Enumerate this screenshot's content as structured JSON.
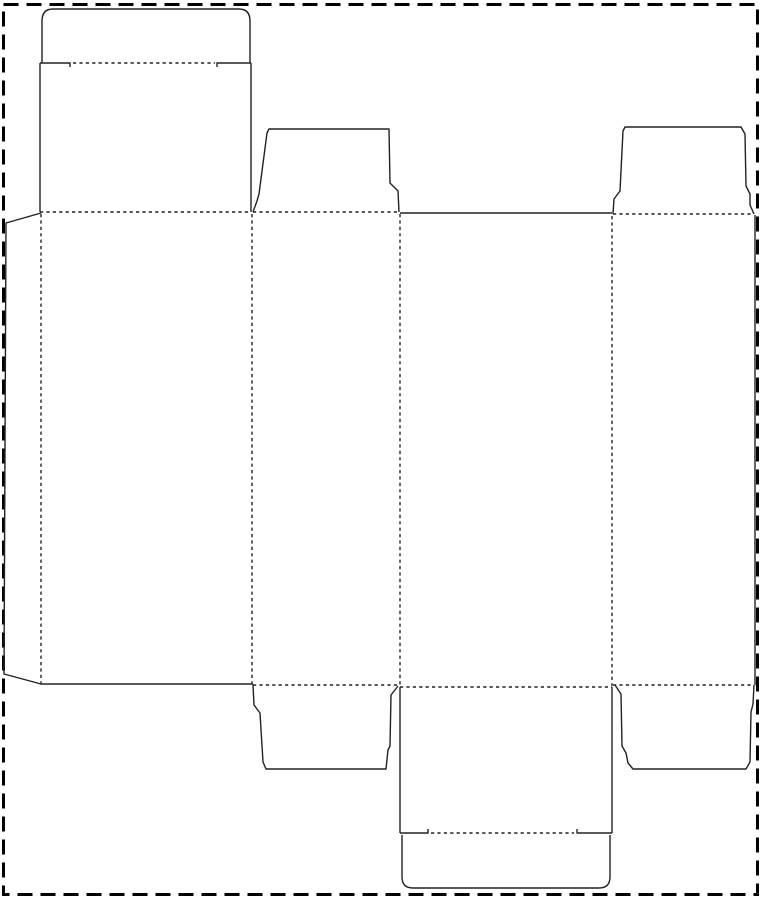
{
  "canvas": {
    "width": 761,
    "height": 900,
    "background_color": "#ffffff"
  },
  "styles": {
    "cut_line_color": "#222222",
    "cut_line_width": 1.4,
    "fold_line_color": "#222222",
    "fold_line_width": 1.4,
    "fold_dash_pattern": "3.2,3.2",
    "border_color": "#000000",
    "border_width": 3,
    "border_dash_pattern": "15,8"
  },
  "border_rect": {
    "x": 3.5,
    "y": 4.5,
    "width": 754,
    "height": 890
  },
  "cut_paths": [
    {
      "name": "top-tuck-flap-outline",
      "d": "M42,63 L42,21 Q42,9 53,9 L239,9 Q250,9 250,21 L250,63"
    },
    {
      "name": "top-tuck-fold-left-shoulder",
      "d": "M40,63 L70,63 L70,67"
    },
    {
      "name": "top-tuck-fold-right-shoulder",
      "d": "M217,67 L217,63 L251,63"
    },
    {
      "name": "back-lid-left-edge",
      "d": "M40,63 L40,212"
    },
    {
      "name": "back-lid-right-edge",
      "d": "M251,63 L251,212"
    },
    {
      "name": "glue-flap-outline",
      "d": "M41,213 L6,223 L4,674 L41,684"
    },
    {
      "name": "back-panel-bottom-edge",
      "d": "M40,684 L253,684"
    },
    {
      "name": "top-middle-dust-flap-outline",
      "d": "M253,212 L257,201 L259,194 L267,133 L269,129 L389,129 L390,183 L398,191 L399,212"
    },
    {
      "name": "front-panel-top-edge",
      "d": "M400,213 L612,213"
    },
    {
      "name": "top-right-dust-flap-outline",
      "d": "M613,214 L614,199 L620,191 L623,131 L625,127 L741,127 L745,134 L746,186 L750,194 L750,205 L754,214"
    },
    {
      "name": "right-panel-right-edge",
      "d": "M755,215 L755,685"
    },
    {
      "name": "bottom-middle-dust-flap-outline",
      "d": "M253,685 L254,705 L260,713 L263,762 L266,769 L386,769 L388,750 L390,746 L391,695 L398,686"
    },
    {
      "name": "bottom-lid-left-edge",
      "d": "M400,687 L400,833"
    },
    {
      "name": "bottom-lid-right-edge",
      "d": "M612,687 L612,833"
    },
    {
      "name": "bottom-tuck-fold-left-shoulder",
      "d": "M400,833 L428,833 L428,829"
    },
    {
      "name": "bottom-tuck-fold-right-shoulder",
      "d": "M577,829 L577,833 L612,833"
    },
    {
      "name": "bottom-tuck-flap-outline",
      "d": "M402,835 L402,877 Q402,888 413,888 L599,888 Q610,888 610,877 L610,835"
    },
    {
      "name": "bottom-right-dust-flap-outline",
      "d": "M615,685 L621,694 L622,746 L626,753 L628,763 L633,769 L746,769 L750,762 L751,712 L753,704 L754,685"
    }
  ],
  "fold_segments": [
    {
      "name": "top-tuck-fold",
      "x1": 73,
      "y1": 63,
      "x2": 215,
      "y2": 63
    },
    {
      "name": "back-lid-fold",
      "x1": 40,
      "y1": 212,
      "x2": 251,
      "y2": 212
    },
    {
      "name": "side-panel-top-fold",
      "x1": 253,
      "y1": 212,
      "x2": 399,
      "y2": 212
    },
    {
      "name": "right-panel-top-fold",
      "x1": 613,
      "y1": 214,
      "x2": 754,
      "y2": 214
    },
    {
      "name": "glue-flap-fold",
      "x1": 41,
      "y1": 214,
      "x2": 41,
      "y2": 683
    },
    {
      "name": "fold-back-to-side",
      "x1": 252,
      "y1": 214,
      "x2": 252,
      "y2": 684
    },
    {
      "name": "fold-side-to-front",
      "x1": 400,
      "y1": 214,
      "x2": 400,
      "y2": 686
    },
    {
      "name": "fold-front-to-right",
      "x1": 612,
      "y1": 216,
      "x2": 612,
      "y2": 686
    },
    {
      "name": "side-panel-bottom-fold",
      "x1": 253,
      "y1": 685,
      "x2": 399,
      "y2": 685
    },
    {
      "name": "front-lid-fold",
      "x1": 400,
      "y1": 687,
      "x2": 612,
      "y2": 687
    },
    {
      "name": "right-panel-bottom-fold",
      "x1": 613,
      "y1": 685,
      "x2": 754,
      "y2": 685
    },
    {
      "name": "bottom-tuck-fold",
      "x1": 431,
      "y1": 833,
      "x2": 574,
      "y2": 833
    }
  ]
}
